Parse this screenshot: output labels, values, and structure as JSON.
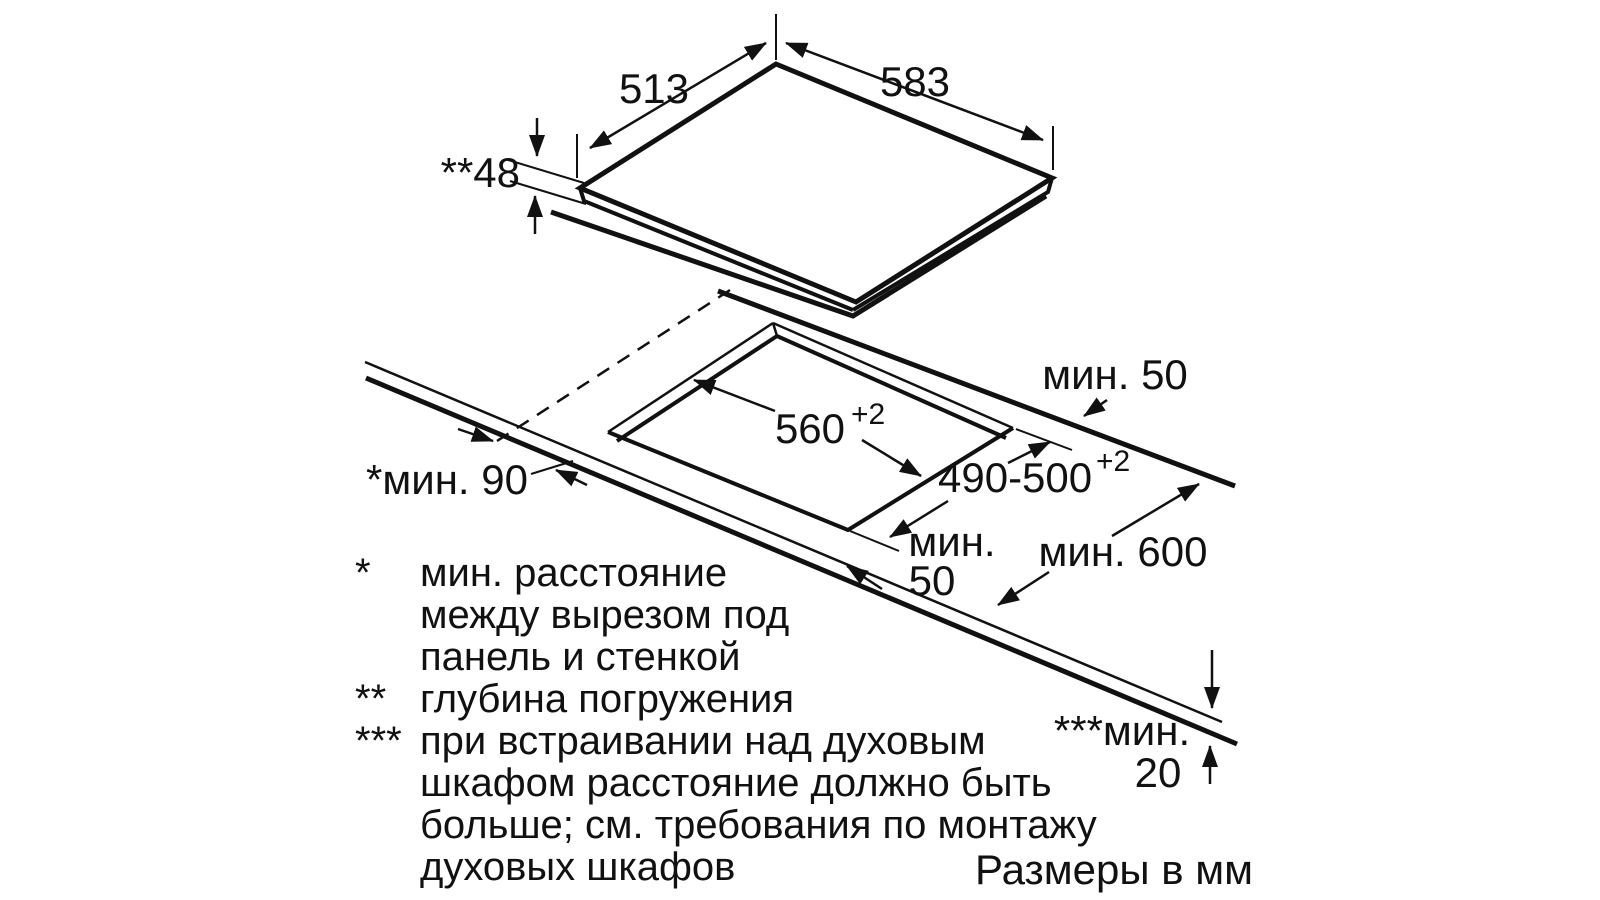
{
  "diagram": {
    "units_note": "Размеры в мм",
    "dims": {
      "depth": "513",
      "width": "583",
      "submersion": "**48",
      "cutout_width": "560",
      "cutout_width_tol": "+2",
      "cutout_depth": "490-500",
      "cutout_depth_tol": "+2",
      "rear_clearance": "мин. 50",
      "front_clearance_l1": "мин.",
      "front_clearance_l2": "50",
      "worktop_depth": "мин. 600",
      "wall_clearance": "*мин. 90",
      "oven_gap_l1": "***мин.",
      "oven_gap_l2": "20"
    },
    "footnotes": {
      "star1_marker": "*",
      "star1_l1": "мин. расстояние",
      "star1_l2": "между вырезом под",
      "star1_l3": "панель и стенкой",
      "star2_marker": "**",
      "star2_l1": "глубина погружения",
      "star3_marker": "***",
      "star3_l1": "при встраивании над духовым",
      "star3_l2": "шкафом расстояние должно быть",
      "star3_l3": "больше; см. требования по монтажу",
      "star3_l4": "духовых шкафов"
    }
  }
}
